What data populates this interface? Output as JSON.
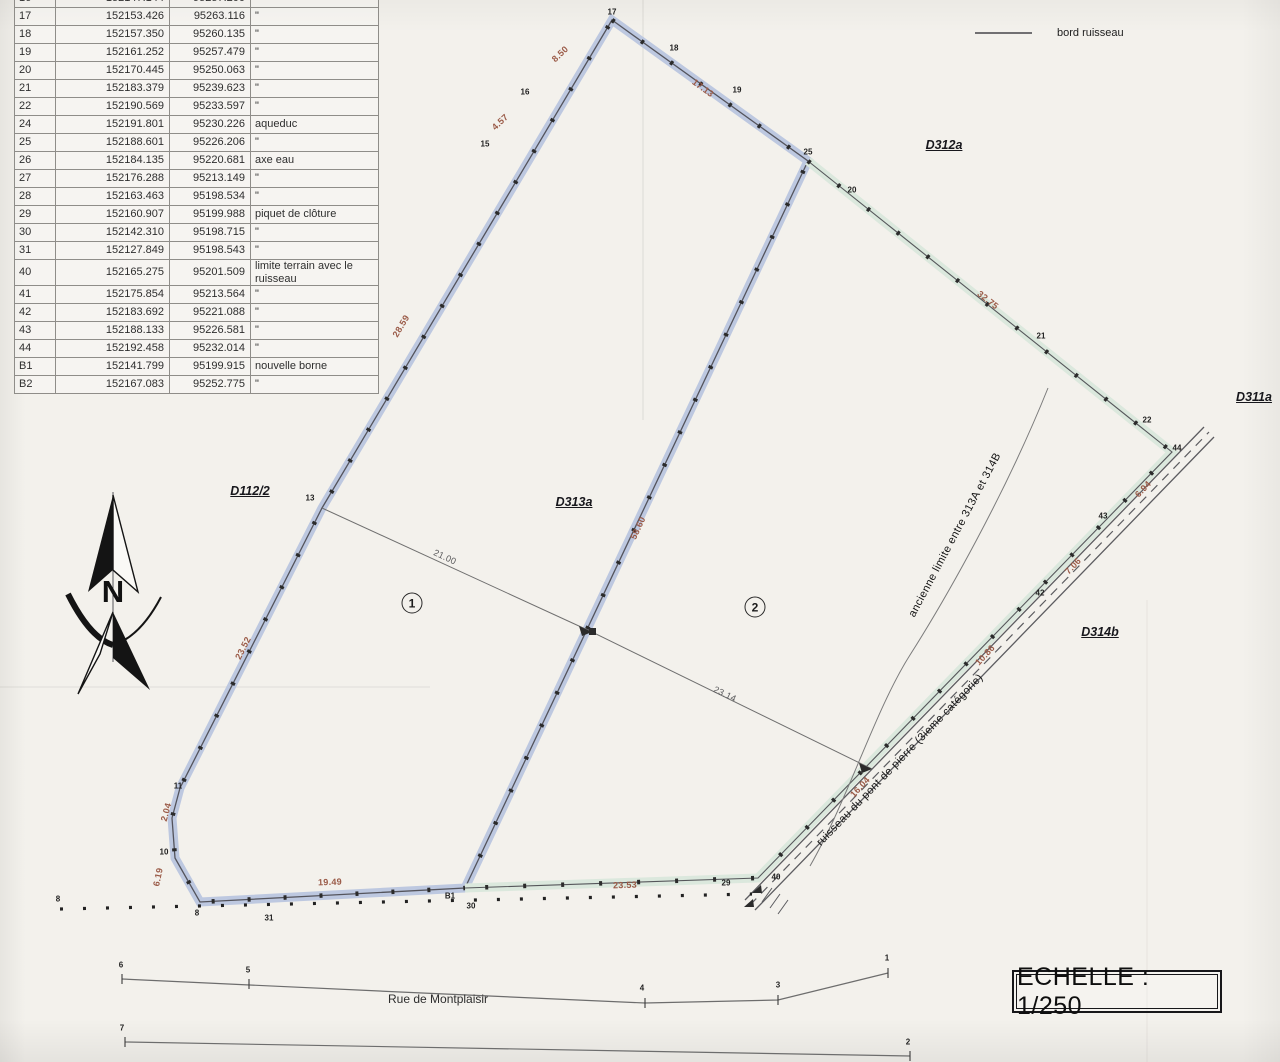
{
  "colors": {
    "band_blue": "#bdc8e0",
    "band_green": "#dbe8dd",
    "boundary_line": "#54545c",
    "dimension_text": "#9a5a47",
    "point_marker": "#2b2b2b"
  },
  "coordinate_table": {
    "rows": [
      {
        "id": "16",
        "x": "152147.144",
        "y": "95257.200",
        "d": "",
        "partial": true
      },
      {
        "id": "17",
        "x": "152153.426",
        "y": "95263.116",
        "d": "\""
      },
      {
        "id": "18",
        "x": "152157.350",
        "y": "95260.135",
        "d": "\""
      },
      {
        "id": "19",
        "x": "152161.252",
        "y": "95257.479",
        "d": "\""
      },
      {
        "id": "20",
        "x": "152170.445",
        "y": "95250.063",
        "d": "\""
      },
      {
        "id": "21",
        "x": "152183.379",
        "y": "95239.623",
        "d": "\""
      },
      {
        "id": "22",
        "x": "152190.569",
        "y": "95233.597",
        "d": "\""
      },
      {
        "id": "24",
        "x": "152191.801",
        "y": "95230.226",
        "d": "aqueduc"
      },
      {
        "id": "25",
        "x": "152188.601",
        "y": "95226.206",
        "d": "\""
      },
      {
        "id": "26",
        "x": "152184.135",
        "y": "95220.681",
        "d": "axe eau"
      },
      {
        "id": "27",
        "x": "152176.288",
        "y": "95213.149",
        "d": "\""
      },
      {
        "id": "28",
        "x": "152163.463",
        "y": "95198.534",
        "d": "\""
      },
      {
        "id": "29",
        "x": "152160.907",
        "y": "95199.988",
        "d": "piquet de clôture"
      },
      {
        "id": "30",
        "x": "152142.310",
        "y": "95198.715",
        "d": "\""
      },
      {
        "id": "31",
        "x": "152127.849",
        "y": "95198.543",
        "d": "\""
      },
      {
        "id": "40",
        "x": "152165.275",
        "y": "95201.509",
        "d": "limite terrain avec le ruisseau"
      },
      {
        "id": "41",
        "x": "152175.854",
        "y": "95213.564",
        "d": "\""
      },
      {
        "id": "42",
        "x": "152183.692",
        "y": "95221.088",
        "d": "\""
      },
      {
        "id": "43",
        "x": "152188.133",
        "y": "95226.581",
        "d": "\""
      },
      {
        "id": "44",
        "x": "152192.458",
        "y": "95232.014",
        "d": "\""
      },
      {
        "id": "B1",
        "x": "152141.799",
        "y": "95199.915",
        "d": "nouvelle borne"
      },
      {
        "id": "B2",
        "x": "152167.083",
        "y": "95252.775",
        "d": "\""
      }
    ]
  },
  "legend": {
    "items": [
      {
        "label": "bord ruisseau"
      }
    ]
  },
  "scale": {
    "label": "ECHELLE : 1/250"
  },
  "street": {
    "label": "Rue de Montplaisir"
  },
  "north": {
    "letter": "N"
  },
  "parcels": {
    "labels": [
      {
        "text": "D312a",
        "x": 944,
        "y": 145
      },
      {
        "text": "D311a",
        "x": 1254,
        "y": 397
      },
      {
        "text": "D112/2",
        "x": 250,
        "y": 491
      },
      {
        "text": "D313a",
        "x": 574,
        "y": 502
      },
      {
        "text": "D314b",
        "x": 1100,
        "y": 632
      }
    ],
    "numbers": [
      {
        "text": "1",
        "x": 412,
        "y": 603
      },
      {
        "text": "2",
        "x": 755,
        "y": 607
      }
    ]
  },
  "annotations": [
    {
      "text": "ancienne limite entre 313A et 314B",
      "x": 955,
      "y": 535,
      "rot": -62
    },
    {
      "text": "ruisseau du pont de pierre (3ieme catégorie)",
      "x": 900,
      "y": 760,
      "rot": -46
    }
  ],
  "dimensions": [
    {
      "text": "8.50",
      "x": 560,
      "y": 54,
      "rot": -43
    },
    {
      "text": "4.57",
      "x": 500,
      "y": 122,
      "rot": -43
    },
    {
      "text": "17.13",
      "x": 703,
      "y": 88,
      "rot": 36
    },
    {
      "text": "32.75",
      "x": 988,
      "y": 300,
      "rot": 38
    },
    {
      "text": "28.59",
      "x": 401,
      "y": 326,
      "rot": -59
    },
    {
      "text": "23.52",
      "x": 243,
      "y": 648,
      "rot": -63
    },
    {
      "text": "2.04",
      "x": 166,
      "y": 812,
      "rot": -75
    },
    {
      "text": "6.19",
      "x": 158,
      "y": 877,
      "rot": -78
    },
    {
      "text": "58.60",
      "x": 638,
      "y": 528,
      "rot": -65
    },
    {
      "text": "21.00",
      "x": 445,
      "y": 557,
      "rot": 25,
      "cls": "gray"
    },
    {
      "text": "23.14",
      "x": 725,
      "y": 694,
      "rot": 26,
      "cls": "gray"
    },
    {
      "text": "19.49",
      "x": 330,
      "y": 882,
      "rot": -2
    },
    {
      "text": "23.53",
      "x": 625,
      "y": 885,
      "rot": -2
    },
    {
      "text": "6.94",
      "x": 1143,
      "y": 489,
      "rot": -47
    },
    {
      "text": "7.06",
      "x": 1073,
      "y": 566,
      "rot": -47
    },
    {
      "text": "10.86",
      "x": 985,
      "y": 655,
      "rot": -47
    },
    {
      "text": "16.04",
      "x": 860,
      "y": 787,
      "rot": -47
    }
  ],
  "points": [
    {
      "text": "17",
      "x": 612,
      "y": 12
    },
    {
      "text": "18",
      "x": 674,
      "y": 48
    },
    {
      "text": "19",
      "x": 737,
      "y": 90
    },
    {
      "text": "16",
      "x": 525,
      "y": 92
    },
    {
      "text": "15",
      "x": 485,
      "y": 144
    },
    {
      "text": "25",
      "x": 808,
      "y": 152
    },
    {
      "text": "20",
      "x": 852,
      "y": 190
    },
    {
      "text": "21",
      "x": 1041,
      "y": 336
    },
    {
      "text": "22",
      "x": 1147,
      "y": 420
    },
    {
      "text": "44",
      "x": 1177,
      "y": 448
    },
    {
      "text": "43",
      "x": 1103,
      "y": 516
    },
    {
      "text": "42",
      "x": 1040,
      "y": 593
    },
    {
      "text": "13",
      "x": 310,
      "y": 498
    },
    {
      "text": "11",
      "x": 178,
      "y": 786
    },
    {
      "text": "10",
      "x": 164,
      "y": 852
    },
    {
      "text": "8",
      "x": 197,
      "y": 913
    },
    {
      "text": "31",
      "x": 269,
      "y": 918
    },
    {
      "text": "B1",
      "x": 450,
      "y": 896
    },
    {
      "text": "30",
      "x": 471,
      "y": 906
    },
    {
      "text": "29",
      "x": 726,
      "y": 883
    },
    {
      "text": "40",
      "x": 776,
      "y": 877
    },
    {
      "text": "8",
      "x": 58,
      "y": 899
    },
    {
      "text": "6",
      "x": 121,
      "y": 965
    },
    {
      "text": "5",
      "x": 248,
      "y": 970
    },
    {
      "text": "4",
      "x": 642,
      "y": 988
    },
    {
      "text": "3",
      "x": 778,
      "y": 985
    },
    {
      "text": "1",
      "x": 887,
      "y": 958
    },
    {
      "text": "7",
      "x": 122,
      "y": 1028
    },
    {
      "text": "2",
      "x": 908,
      "y": 1042
    }
  ]
}
